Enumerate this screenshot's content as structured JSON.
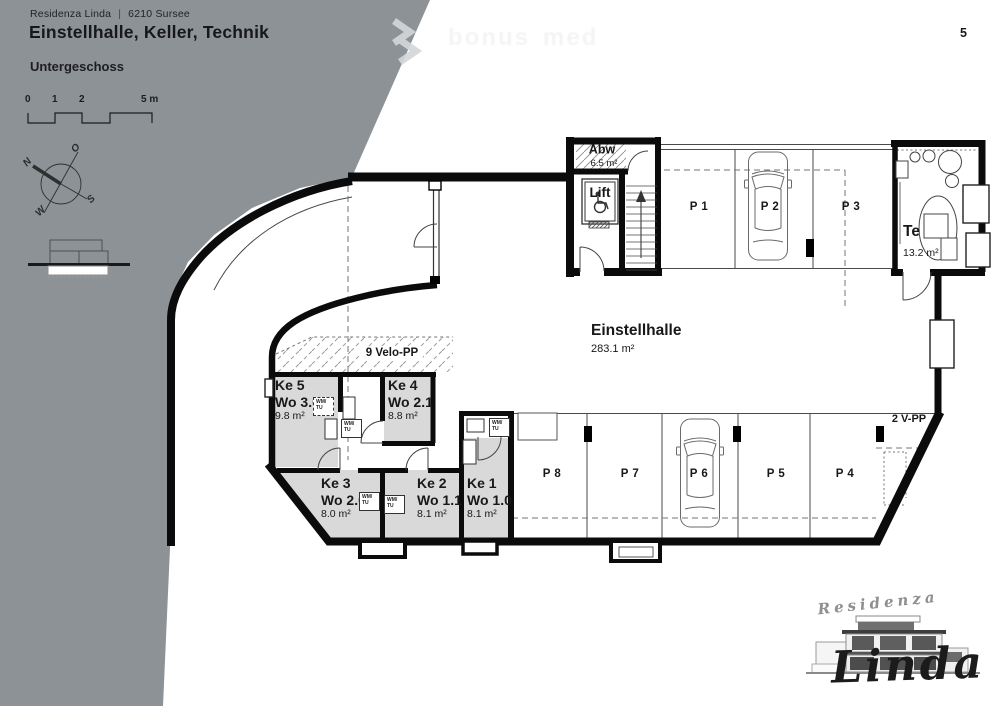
{
  "header": {
    "brand": "Residenza Linda",
    "separator": "|",
    "location": "6210 Sursee",
    "title": "Einstellhalle, Keller, Technik",
    "subtitle": "Untergeschoss",
    "page_number": "5"
  },
  "scalebar": {
    "tick0": "0",
    "tick1": "1",
    "tick2": "2",
    "tick5": "5 m"
  },
  "compass": {
    "north": "N",
    "east": "O",
    "south": "S",
    "west": "W"
  },
  "watermark": {
    "word1": "bonus",
    "word2": "med"
  },
  "plan": {
    "einstellhalle": {
      "name": "Einstellhalle",
      "area": "283.1 m²"
    },
    "abw": {
      "name": "Abw",
      "area": "6.5 m²"
    },
    "lift": {
      "name": "Lift"
    },
    "te": {
      "name": "Te",
      "area": "13.2 m²"
    },
    "velo_label": "9 Velo-PP",
    "vpp_label": "2 V-PP",
    "wm_line1": "WM/",
    "wm_line2": "TU",
    "parking": {
      "p1": "P 1",
      "p2": "P 2",
      "p3": "P 3",
      "p4": "P 4",
      "p5": "P 5",
      "p6": "P 6",
      "p7": "P 7",
      "p8": "P 8"
    },
    "keller": [
      {
        "name": "Ke 1",
        "unit": "Wo 1.0",
        "area": "8.1 m²"
      },
      {
        "name": "Ke 2",
        "unit": "Wo 1.1",
        "area": "8.1 m²"
      },
      {
        "name": "Ke 3",
        "unit": "Wo 2.0",
        "area": "8.0 m²"
      },
      {
        "name": "Ke 4",
        "unit": "Wo 2.1",
        "area": "8.8 m²"
      },
      {
        "name": "Ke 5",
        "unit": "Wo 3.0",
        "area": "9.8 m²"
      }
    ]
  },
  "logo": {
    "script_top": "Residenza",
    "script_bottom": "Linda"
  }
}
